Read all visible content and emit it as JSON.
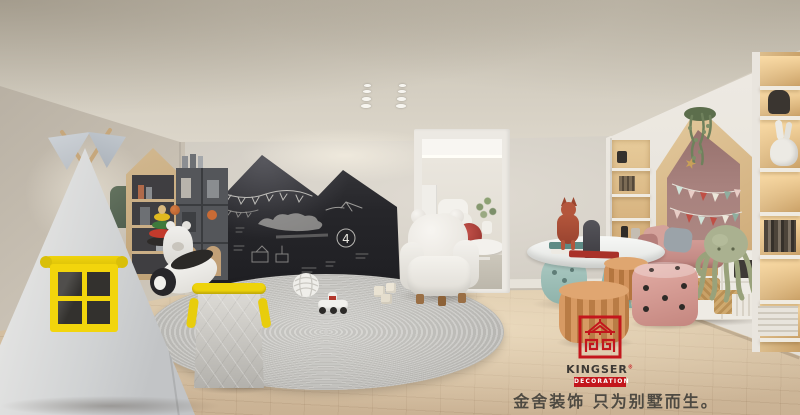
{
  "watermark": {
    "brand": "KINGSER",
    "registered_mark": "®",
    "brand_sub": "DECORATION",
    "slogan": "金舍装饰 只为别墅而生。",
    "logo_red": "#c3161c"
  },
  "chalkboard": {
    "badge_number": "4"
  },
  "nook": {
    "starfish_glyph": "★"
  },
  "palette": {
    "ceiling": "#d2ccbf",
    "wall": "#d8d3ca",
    "floor_wood": "#d7c4a6",
    "chalkboard": "#27272a",
    "teepee_gray": "#d6d7d8",
    "accent_yellow": "#f2d50c",
    "accent_mint": "#a5c5be",
    "accent_pink": "#d49793",
    "accent_orange": "#c8854f",
    "nook_pink": "#a8827e",
    "shelf_wood": "#d5b385"
  }
}
